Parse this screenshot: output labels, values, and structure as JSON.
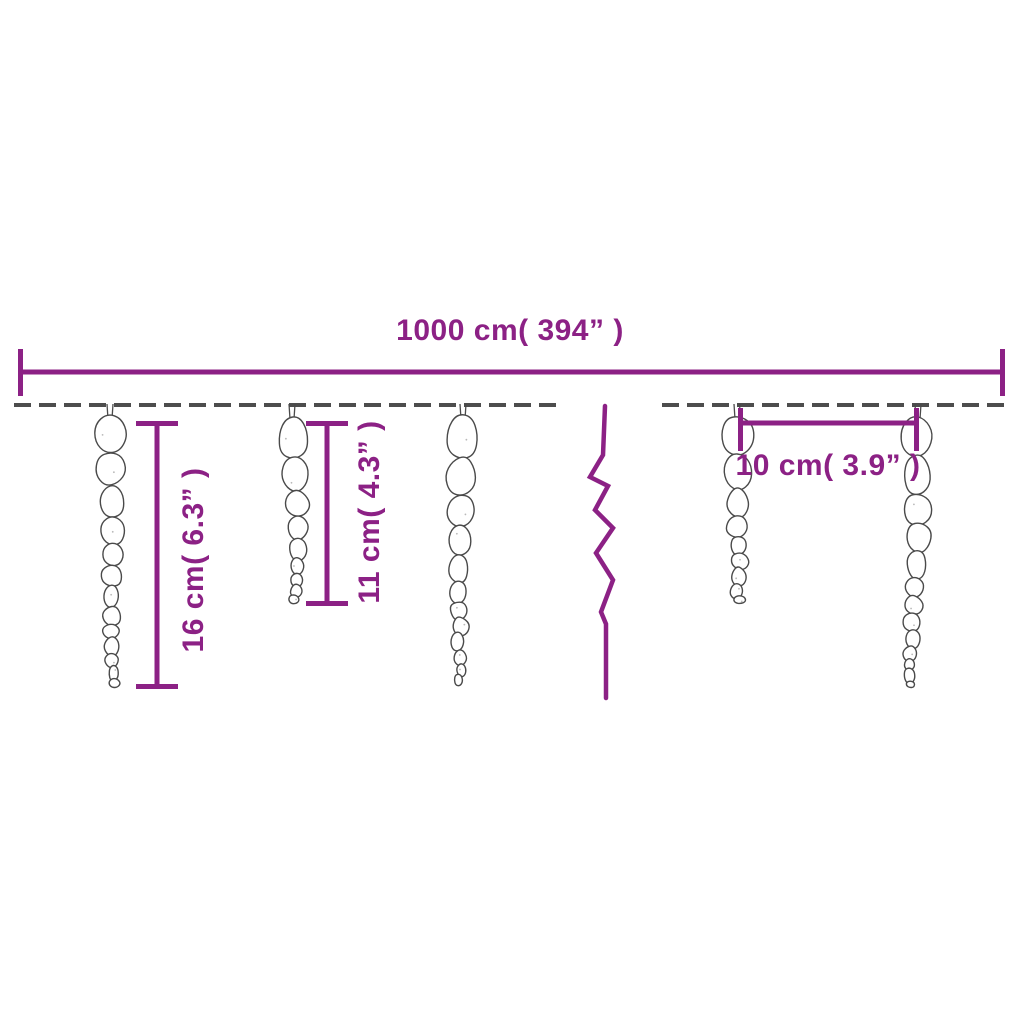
{
  "diagram": {
    "title": "icicle-string-lights-dimensions",
    "colors": {
      "accent": "#8c2185",
      "wire": "#4d4d4d",
      "icicle_outline": "#4a4a4a",
      "background": "#ffffff"
    },
    "annotations": {
      "total_length": {
        "text": "1000 cm( 394” )",
        "value_cm": 1000,
        "value_inch": 394,
        "line": {
          "y": 372,
          "x1": 18,
          "x2": 1005
        },
        "label": {
          "x": 510,
          "y": 331
        }
      },
      "long_icicle": {
        "text": "16 cm( 6.3” )",
        "value_cm": 16,
        "value_inch": 6.3,
        "line": {
          "x": 157,
          "y1": 421,
          "y2": 689
        },
        "label": {
          "x": 194,
          "y": 560
        }
      },
      "short_icicle": {
        "text": "11 cm( 4.3” )",
        "value_cm": 11,
        "value_inch": 4.3,
        "line": {
          "x": 327,
          "y1": 421,
          "y2": 606
        },
        "label": {
          "x": 370,
          "y": 512
        }
      },
      "icicle_spacing": {
        "text": "10 cm( 3.9” )",
        "value_cm": 10,
        "value_inch": 3.9,
        "line": {
          "y": 423,
          "x1": 738,
          "x2": 919
        },
        "label": {
          "x": 828,
          "y": 466
        }
      }
    },
    "figure": {
      "wire_y": 405,
      "wire_segments": [
        {
          "x1": 14,
          "x2": 560
        },
        {
          "x1": 662,
          "x2": 1008
        }
      ],
      "break_x": 605,
      "icicles": [
        {
          "x": 110,
          "top": 414,
          "bottom": 688,
          "size": "long"
        },
        {
          "x": 292,
          "top": 414,
          "bottom": 604,
          "size": "short"
        },
        {
          "x": 463,
          "top": 414,
          "bottom": 688,
          "size": "long"
        },
        {
          "x": 737,
          "top": 414,
          "bottom": 604,
          "size": "short"
        },
        {
          "x": 918,
          "top": 414,
          "bottom": 688,
          "size": "long"
        }
      ]
    }
  }
}
